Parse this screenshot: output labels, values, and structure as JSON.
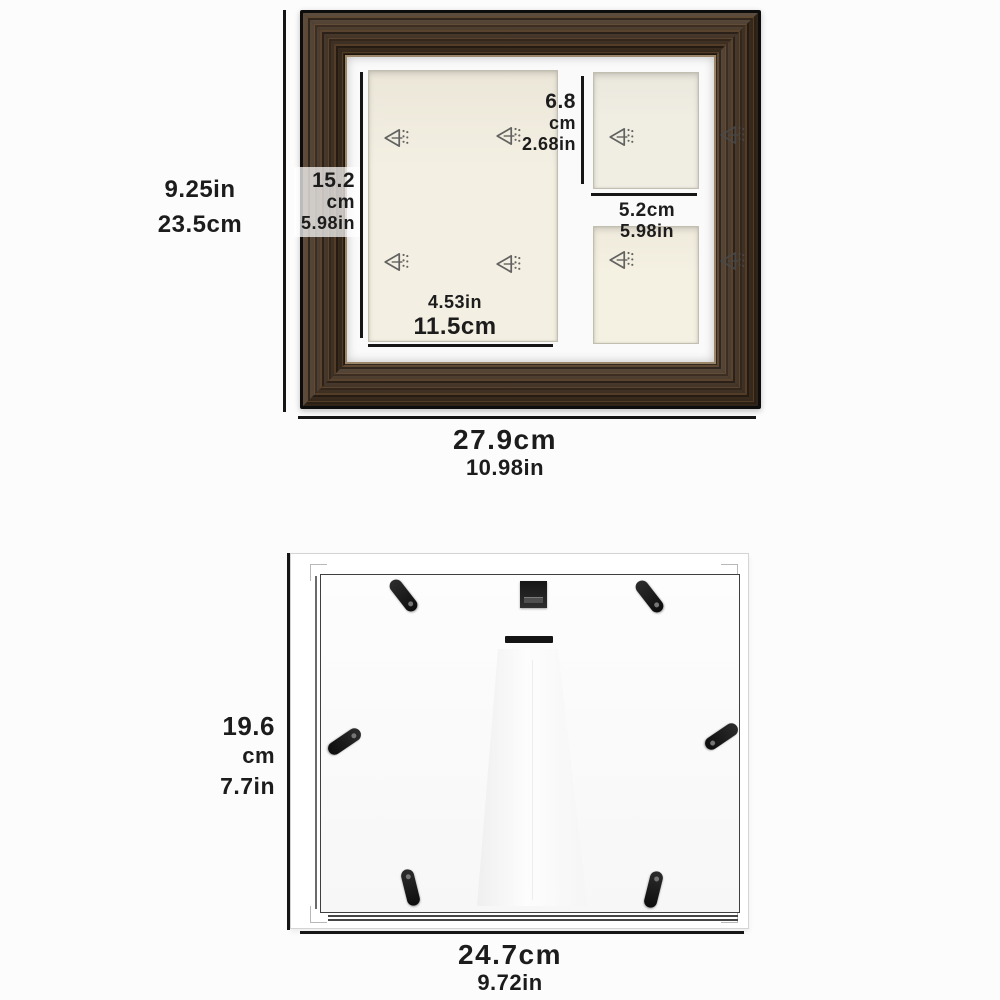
{
  "front_view": {
    "outer_height_in": "9.25in",
    "outer_height_cm": "23.5cm",
    "outer_width_cm": "27.9cm",
    "outer_width_in": "10.98in",
    "main_opening": {
      "height_cm_value": "15.2",
      "height_cm_unit": "cm",
      "height_in": "5.98in",
      "width_in": "4.53in",
      "width_cm": "11.5cm"
    },
    "small_opening": {
      "height_cm_value": "6.8",
      "height_cm_unit": "cm",
      "height_in": "2.68in",
      "width_cm": "5.2cm",
      "width_in": "5.98in"
    }
  },
  "back_view": {
    "height_cm_value": "19.6",
    "height_cm_unit": "cm",
    "height_in": "7.7in",
    "width_cm": "24.7cm",
    "width_in": "9.72in"
  },
  "icons": {
    "watermark": "brand-watermark-triangle"
  },
  "colors": {
    "background": "#fcfcfc",
    "frame_wood": "#42301f",
    "frame_edge": "#0d0d0d",
    "mat": "#fafafa",
    "insert_paper": "#f2eddf",
    "dimension_line": "#161616",
    "dimension_text": "#1c1c1c",
    "back_panel": "#ffffff",
    "hardware_black": "#1a1a1a"
  }
}
